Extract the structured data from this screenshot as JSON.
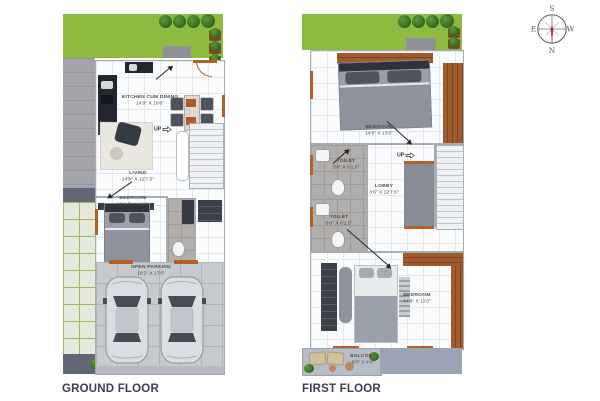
{
  "compass": {
    "top": "S",
    "bottom": "N",
    "left": "E",
    "right": "W"
  },
  "icons": {
    "up_arrow": "⇨"
  },
  "ground_floor": {
    "title": "GROUND FLOOR",
    "up_label": "UP",
    "rooms": {
      "kitchen": {
        "name": "KITCHEN CUM DINING",
        "dims": "14'9\" X 10'0\""
      },
      "living": {
        "name": "LIVING",
        "dims": "14'9\" X 12'7.5\""
      },
      "bedroom": {
        "name": "BEDROOM",
        "dims": "10'4.5\" X 11'0\""
      },
      "parking": {
        "name": "OPEN PARKING",
        "dims": "19'2\" X 17'0\""
      }
    }
  },
  "first_floor": {
    "title": "FIRST FLOOR",
    "up_label": "UP",
    "rooms": {
      "bedroom_top": {
        "name": "BEDROOM",
        "dims": "14'9\" X 10'0\""
      },
      "toilet_top": {
        "name": "TOILET",
        "dims": "5'8\" X 6'1.5\""
      },
      "lobby": {
        "name": "LOBBY",
        "dims": "3'6\" X 12'7.5\""
      },
      "toilet_bottom": {
        "name": "TOILET",
        "dims": "5'8\" X 6'1.5\""
      },
      "bedroom_bottom": {
        "name": "BEDROOM",
        "dims": "14'9\" X 11'0\""
      },
      "balcony": {
        "name": "BALCONY",
        "dims": "8'0\" X 4'0\""
      }
    }
  },
  "colors": {
    "lawn": "#8cbb40",
    "wood_accent": "#b55f2b",
    "slab": "#c6c9ce",
    "needle_red": "#c22d3c",
    "title_text": "#3b4052"
  }
}
